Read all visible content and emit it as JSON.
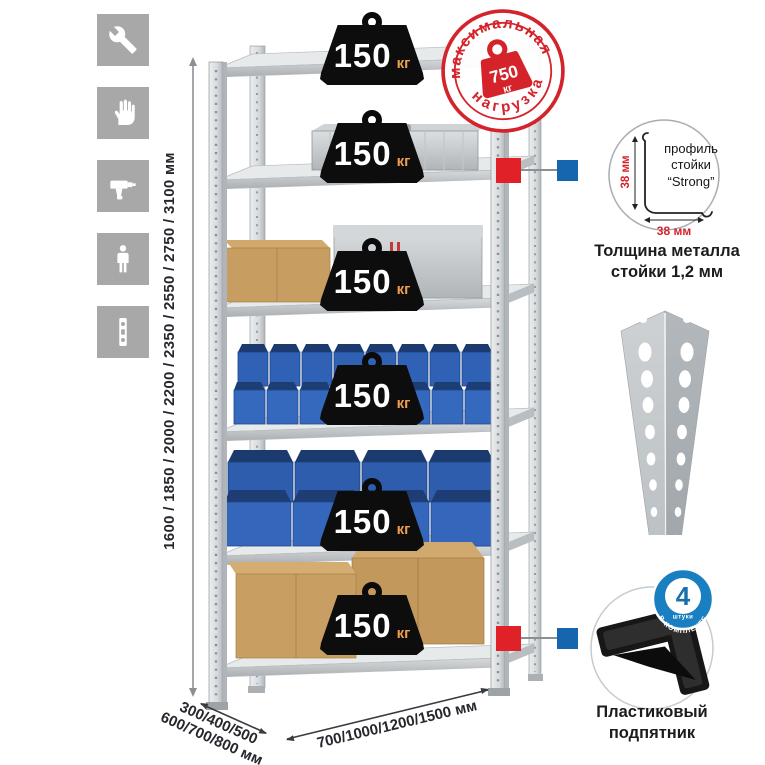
{
  "page": {
    "background": "#ffffff"
  },
  "assembly_icons": {
    "tile_color": "#a8a8a8",
    "glyph_color": "#ffffff",
    "items": [
      {
        "name": "wrench-icon"
      },
      {
        "name": "gloves-icon"
      },
      {
        "name": "drill-icon"
      },
      {
        "name": "person-icon"
      },
      {
        "name": "level-icon"
      }
    ]
  },
  "dimensions": {
    "height_label": "1600 / 1850 / 2000 / 2200 / 2350 / 2550 / 2750 / 3100 мм",
    "depth_label_line1": "300/400/500",
    "depth_label_line2": "600/700/800 мм",
    "width_label": "700/1000/1200/1500 мм"
  },
  "shelf_load_badges": {
    "count": 6,
    "value": "150",
    "unit": "кг",
    "badge_color": "#0d0d0d"
  },
  "max_load_stamp": {
    "arc_top": "максимальная",
    "arc_bottom": "нагрузка",
    "value": "750",
    "unit": "кг",
    "color": "#d5232b"
  },
  "profile_callout": {
    "label_line1": "профиль",
    "label_line2": "стойки",
    "label_line3": "“Strong”",
    "dim_vertical": "38 мм",
    "dim_horizontal": "38 мм",
    "dim_color": "#d5232b",
    "caption_line1": "Толщина металла",
    "caption_line2": "стойки 1,2 мм"
  },
  "foot_callout": {
    "badge_number": "4",
    "badge_sub": "штуки",
    "badge_ring_text": "в комплекте",
    "badge_color": "#1a7fc0",
    "caption_line1": "Пластиковый",
    "caption_line2": "подпятник"
  },
  "connector_colors": {
    "red": "#e02128",
    "blue": "#1566ad"
  }
}
